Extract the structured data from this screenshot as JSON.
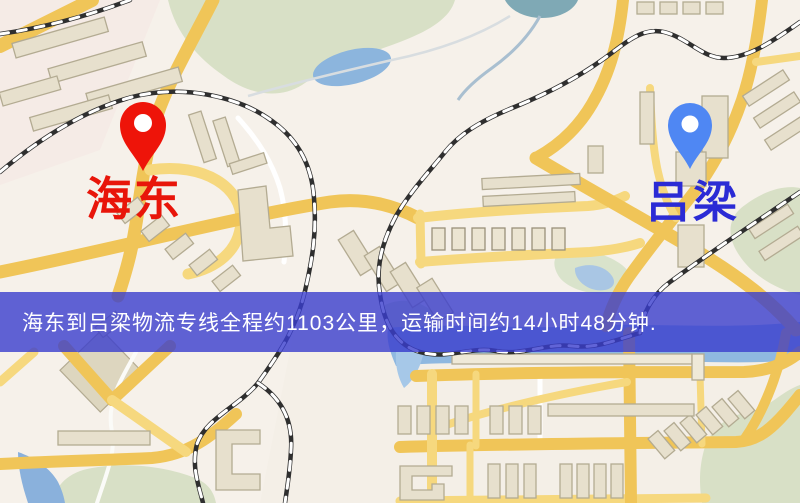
{
  "map": {
    "type": "street-map",
    "palette": {
      "background": "#f6f1ea",
      "road_yellow": "#f0c558",
      "road_yellow_minor": "#f6d87e",
      "park_green": "#d8e0c6",
      "water_blue": "#8fb8e0",
      "building_tan": "#e7e0cd",
      "railway_dark": "#333333"
    }
  },
  "markers": {
    "origin": {
      "label": "海东",
      "label_color": "#e8150a",
      "pin_color": "#ee1409"
    },
    "destination": {
      "label": "吕梁",
      "label_color": "#2b2bd5",
      "pin_color": "#4f87f3"
    }
  },
  "banner": {
    "text": "海东到吕梁物流专线全程约1103公里，运输时间约14小时48分钟.",
    "background_color": "#3a3dcd",
    "text_color": "#ffffff",
    "origin": "海东",
    "destination": "吕梁",
    "distance_text": "约1103公里",
    "duration_text": "约14小时48分钟"
  }
}
